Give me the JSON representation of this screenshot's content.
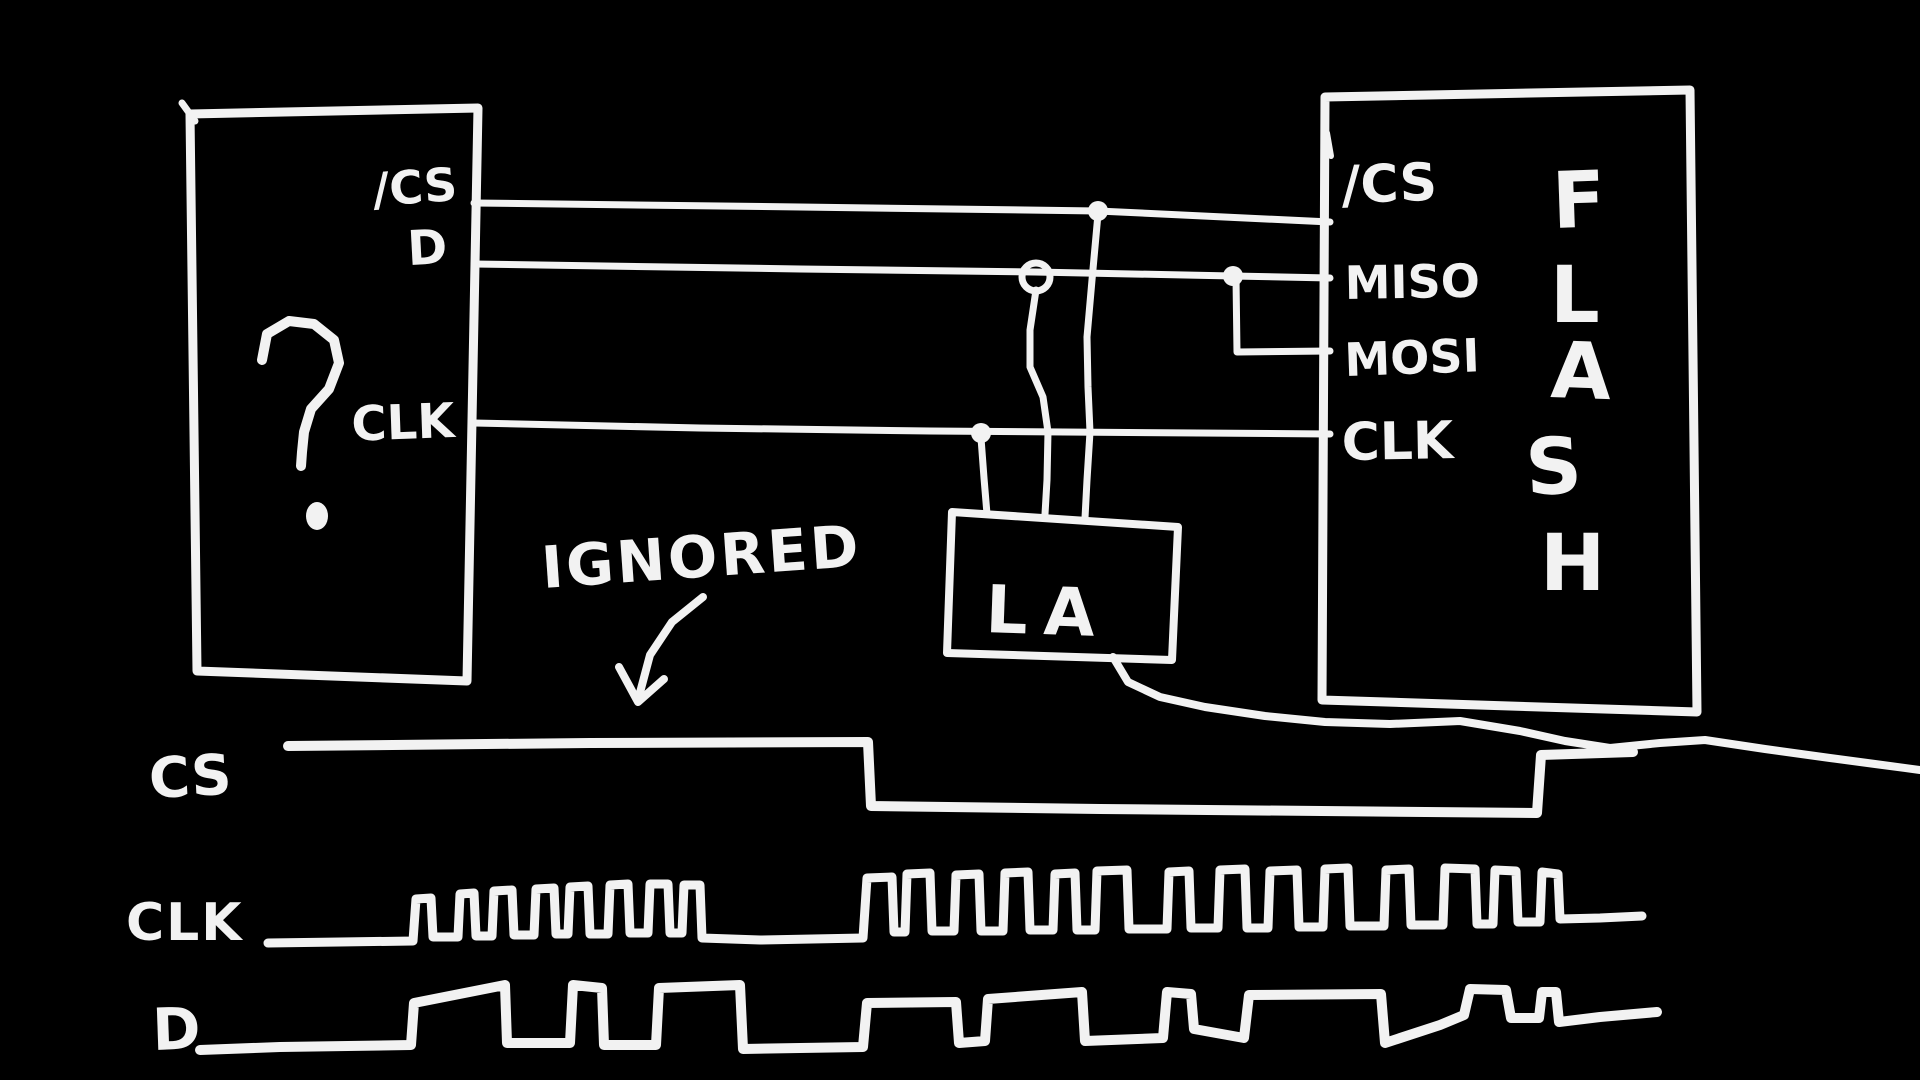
{
  "colors": {
    "background": "#000000",
    "ink": "#f2f2f2"
  },
  "device_box": {
    "label": "?",
    "pins": [
      {
        "label": "/CS"
      },
      {
        "label": "D"
      },
      {
        "label": "CLK"
      }
    ]
  },
  "flash_box": {
    "name": "FLASH",
    "letters": [
      "F",
      "L",
      "A",
      "S",
      "H"
    ],
    "pins": [
      {
        "label": "/CS"
      },
      {
        "label": "MISO"
      },
      {
        "label": "MOSI"
      },
      {
        "label": "CLK"
      }
    ]
  },
  "la_box": {
    "label": "LA"
  },
  "annotation": {
    "label": "IGNORED"
  },
  "timing": {
    "cs": "CS",
    "clk": "CLK",
    "d": "D"
  },
  "diagram": {
    "boxes": [
      {
        "name": "device-box-outline",
        "width": 9,
        "points": [
          [
            190,
            114
          ],
          [
            478,
            108
          ],
          [
            467,
            681
          ],
          [
            197,
            671
          ]
        ]
      },
      {
        "name": "flash-box-outline",
        "width": 9,
        "points": [
          [
            1325,
            97
          ],
          [
            1690,
            90
          ],
          [
            1697,
            712
          ],
          [
            1322,
            700
          ]
        ]
      },
      {
        "name": "la-box-outline",
        "width": 8,
        "points": [
          [
            952,
            512
          ],
          [
            1178,
            527
          ],
          [
            1172,
            660
          ],
          [
            947,
            653
          ]
        ]
      }
    ],
    "strokes": [
      {
        "name": "cs-wire",
        "width": 7,
        "points": [
          [
            474,
            203
          ],
          [
            800,
            207
          ],
          [
            1098,
            211
          ],
          [
            1330,
            222
          ]
        ]
      },
      {
        "name": "d-wire",
        "width": 7,
        "points": [
          [
            474,
            264
          ],
          [
            800,
            269
          ],
          [
            1035,
            272
          ],
          [
            1233,
            276
          ],
          [
            1330,
            278
          ]
        ]
      },
      {
        "name": "clk-wire",
        "width": 7,
        "points": [
          [
            474,
            423
          ],
          [
            700,
            428
          ],
          [
            930,
            431
          ],
          [
            1330,
            434
          ]
        ]
      },
      {
        "name": "miso-mosi-jog-wire",
        "width": 7,
        "points": [
          [
            1236,
            278
          ],
          [
            1237,
            352
          ],
          [
            1330,
            351
          ]
        ]
      },
      {
        "name": "cs-tap-wire",
        "width": 7,
        "points": [
          [
            1098,
            214
          ],
          [
            1092,
            280
          ],
          [
            1087,
            337
          ],
          [
            1088,
            387
          ],
          [
            1090,
            432
          ],
          [
            1087,
            480
          ],
          [
            1085,
            518
          ]
        ]
      },
      {
        "name": "d-tap-wire",
        "width": 7,
        "points": [
          [
            1036,
            290
          ],
          [
            1030,
            330
          ],
          [
            1030,
            367
          ],
          [
            1043,
            397
          ],
          [
            1048,
            432
          ],
          [
            1047,
            480
          ],
          [
            1045,
            514
          ]
        ]
      },
      {
        "name": "clk-tap-wire",
        "width": 7,
        "points": [
          [
            981,
            438
          ],
          [
            984,
            478
          ],
          [
            987,
            514
          ]
        ]
      },
      {
        "name": "la-cable",
        "width": 8,
        "points": [
          [
            1113,
            657
          ],
          [
            1128,
            682
          ],
          [
            1160,
            697
          ],
          [
            1205,
            707
          ],
          [
            1265,
            716
          ],
          [
            1325,
            722
          ],
          [
            1390,
            724
          ],
          [
            1460,
            721
          ],
          [
            1520,
            731
          ],
          [
            1565,
            741
          ],
          [
            1610,
            748
          ],
          [
            1660,
            743
          ],
          [
            1705,
            740
          ],
          [
            1765,
            749
          ],
          [
            1830,
            758
          ],
          [
            1875,
            764
          ],
          [
            1920,
            770
          ]
        ]
      },
      {
        "name": "device-box-corner-tick",
        "width": 7,
        "points": [
          [
            182,
            103
          ],
          [
            195,
            121
          ]
        ]
      },
      {
        "name": "flash-box-corner-tick",
        "width": 6,
        "points": [
          [
            1327,
            133
          ],
          [
            1331,
            156
          ]
        ]
      },
      {
        "name": "question-mark-stroke",
        "width": 10,
        "points": [
          [
            262,
            360
          ],
          [
            267,
            334
          ],
          [
            289,
            321
          ],
          [
            314,
            324
          ],
          [
            334,
            340
          ],
          [
            339,
            363
          ],
          [
            329,
            389
          ],
          [
            311,
            409
          ],
          [
            304,
            432
          ],
          [
            302,
            452
          ],
          [
            301,
            466
          ]
        ]
      },
      {
        "name": "ignored-arrow-shaft",
        "width": 8,
        "points": [
          [
            703,
            597
          ],
          [
            672,
            622
          ],
          [
            650,
            655
          ],
          [
            638,
            700
          ]
        ]
      },
      {
        "name": "ignored-arrow-head",
        "width": 8,
        "points": [
          [
            619,
            667
          ],
          [
            638,
            702
          ],
          [
            664,
            679
          ]
        ]
      }
    ],
    "waveforms": [
      {
        "name": "cs-waveform",
        "width": 10,
        "points": [
          [
            288,
            746
          ],
          [
            590,
            743
          ],
          [
            868,
            742
          ],
          [
            871,
            806
          ],
          [
            1100,
            809
          ],
          [
            1537,
            813
          ],
          [
            1541,
            755
          ],
          [
            1633,
            752
          ]
        ]
      },
      {
        "name": "clk-waveform",
        "width": 9,
        "points": [
          [
            268,
            943
          ],
          [
            340,
            942
          ],
          [
            413,
            941
          ],
          [
            416,
            899
          ],
          [
            431,
            898
          ],
          [
            433,
            937
          ],
          [
            458,
            937
          ],
          [
            460,
            894
          ],
          [
            474,
            893
          ],
          [
            476,
            936
          ],
          [
            492,
            936
          ],
          [
            494,
            891
          ],
          [
            512,
            890
          ],
          [
            514,
            935
          ],
          [
            534,
            935
          ],
          [
            536,
            889
          ],
          [
            554,
            888
          ],
          [
            556,
            934
          ],
          [
            568,
            934
          ],
          [
            570,
            887
          ],
          [
            588,
            886
          ],
          [
            590,
            934
          ],
          [
            608,
            934
          ],
          [
            610,
            885
          ],
          [
            628,
            884
          ],
          [
            630,
            933
          ],
          [
            648,
            933
          ],
          [
            650,
            884
          ],
          [
            668,
            884
          ],
          [
            670,
            933
          ],
          [
            682,
            933
          ],
          [
            684,
            885
          ],
          [
            700,
            885
          ],
          [
            702,
            938
          ],
          [
            760,
            940
          ],
          [
            863,
            938
          ],
          [
            867,
            878
          ],
          [
            892,
            877
          ],
          [
            894,
            932
          ],
          [
            905,
            932
          ],
          [
            907,
            874
          ],
          [
            930,
            873
          ],
          [
            932,
            931
          ],
          [
            954,
            931
          ],
          [
            956,
            875
          ],
          [
            979,
            874
          ],
          [
            981,
            931
          ],
          [
            1003,
            931
          ],
          [
            1005,
            873
          ],
          [
            1028,
            872
          ],
          [
            1030,
            930
          ],
          [
            1053,
            930
          ],
          [
            1055,
            874
          ],
          [
            1075,
            873
          ],
          [
            1077,
            930
          ],
          [
            1095,
            930
          ],
          [
            1097,
            871
          ],
          [
            1127,
            870
          ],
          [
            1129,
            929
          ],
          [
            1167,
            929
          ],
          [
            1169,
            872
          ],
          [
            1189,
            871
          ],
          [
            1191,
            928
          ],
          [
            1218,
            928
          ],
          [
            1220,
            870
          ],
          [
            1245,
            869
          ],
          [
            1247,
            928
          ],
          [
            1268,
            928
          ],
          [
            1270,
            871
          ],
          [
            1297,
            870
          ],
          [
            1299,
            927
          ],
          [
            1323,
            927
          ],
          [
            1325,
            869
          ],
          [
            1348,
            868
          ],
          [
            1350,
            926
          ],
          [
            1384,
            926
          ],
          [
            1386,
            870
          ],
          [
            1409,
            869
          ],
          [
            1411,
            925
          ],
          [
            1443,
            925
          ],
          [
            1445,
            868
          ],
          [
            1475,
            869
          ],
          [
            1477,
            924
          ],
          [
            1493,
            924
          ],
          [
            1495,
            870
          ],
          [
            1516,
            871
          ],
          [
            1518,
            922
          ],
          [
            1540,
            922
          ],
          [
            1542,
            872
          ],
          [
            1558,
            874
          ],
          [
            1560,
            919
          ],
          [
            1600,
            918
          ],
          [
            1642,
            916
          ]
        ]
      },
      {
        "name": "d-waveform",
        "width": 10,
        "points": [
          [
            200,
            1050
          ],
          [
            280,
            1047
          ],
          [
            411,
            1045
          ],
          [
            414,
            1003
          ],
          [
            505,
            985
          ],
          [
            507,
            1043
          ],
          [
            570,
            1043
          ],
          [
            573,
            985
          ],
          [
            602,
            988
          ],
          [
            604,
            1045
          ],
          [
            656,
            1045
          ],
          [
            659,
            988
          ],
          [
            740,
            985
          ],
          [
            743,
            1049
          ],
          [
            800,
            1048
          ],
          [
            863,
            1047
          ],
          [
            867,
            1003
          ],
          [
            956,
            1002
          ],
          [
            959,
            1043
          ],
          [
            985,
            1041
          ],
          [
            988,
            999
          ],
          [
            1082,
            992
          ],
          [
            1085,
            1041
          ],
          [
            1163,
            1038
          ],
          [
            1167,
            992
          ],
          [
            1191,
            994
          ],
          [
            1194,
            1029
          ],
          [
            1244,
            1038
          ],
          [
            1249,
            995
          ],
          [
            1381,
            994
          ],
          [
            1385,
            1043
          ],
          [
            1440,
            1025
          ],
          [
            1464,
            1015
          ],
          [
            1470,
            989
          ],
          [
            1506,
            990
          ],
          [
            1511,
            1018
          ],
          [
            1539,
            1018
          ],
          [
            1542,
            992
          ],
          [
            1556,
            992
          ],
          [
            1559,
            1022
          ],
          [
            1600,
            1017
          ],
          [
            1657,
            1012
          ]
        ]
      }
    ],
    "dots": [
      {
        "name": "cs-tap-dot",
        "x": 1098,
        "y": 211,
        "rx": 10,
        "ry": 10
      },
      {
        "name": "d-junction-dot",
        "x": 1233,
        "y": 276,
        "rx": 10,
        "ry": 10
      },
      {
        "name": "clk-tap-dot",
        "x": 981,
        "y": 433,
        "rx": 10,
        "ry": 10
      },
      {
        "name": "question-mark-dot",
        "x": 317,
        "y": 516,
        "rx": 11,
        "ry": 14
      }
    ],
    "loops": [
      {
        "name": "d-tap-loop",
        "x": 1036,
        "y": 277,
        "r": 14,
        "width": 7
      }
    ]
  }
}
